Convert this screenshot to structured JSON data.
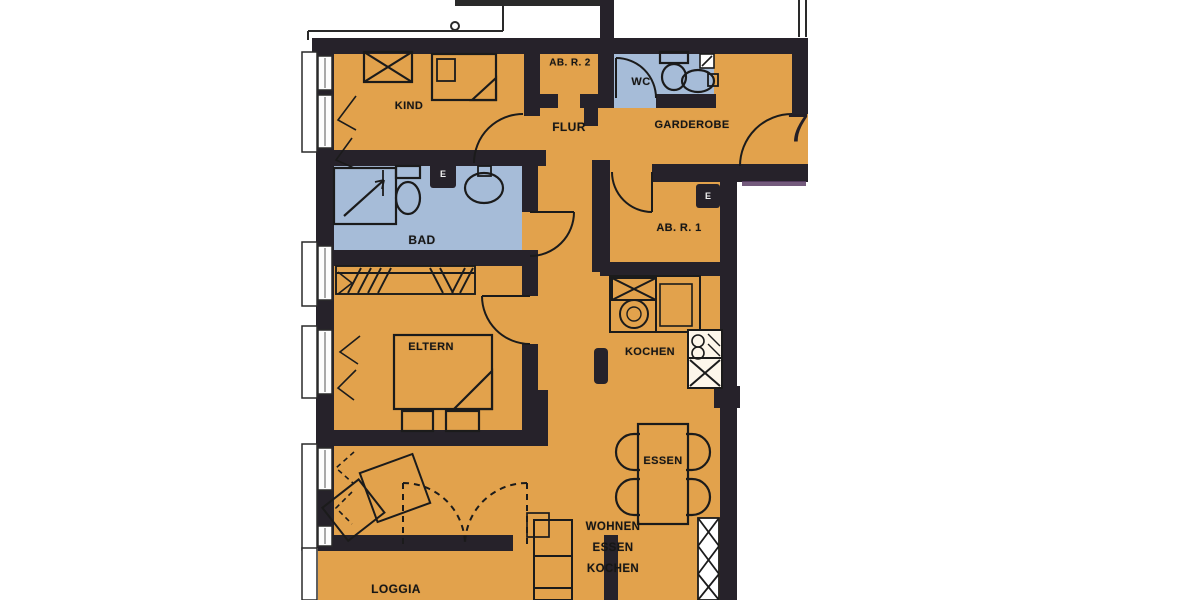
{
  "meta": {
    "apartment_number": "7",
    "drawing_type": "floor plan"
  },
  "colors": {
    "paper": "#ffffff",
    "floor": "#E2A24C",
    "wet": "#A6BCD8",
    "wall": "#26222A",
    "line": "#1b1b1b",
    "artifact": "#5C3E66"
  },
  "rooms": [
    {
      "id": "kind",
      "label": "KIND"
    },
    {
      "id": "ab_r_2",
      "label": "AB. R. 2"
    },
    {
      "id": "wc",
      "label": "WC"
    },
    {
      "id": "flur",
      "label": "FLUR"
    },
    {
      "id": "garderobe",
      "label": "GARDEROBE"
    },
    {
      "id": "bad",
      "label": "BAD"
    },
    {
      "id": "ab_r_1",
      "label": "AB. R. 1"
    },
    {
      "id": "eltern",
      "label": "ELTERN"
    },
    {
      "id": "kochen",
      "label": "KOCHEN"
    },
    {
      "id": "essen",
      "label": "ESSEN"
    },
    {
      "id": "wohnen_essen_kochen",
      "lines": [
        "WOHNEN",
        "ESSEN",
        "KOCHEN"
      ]
    },
    {
      "id": "loggia",
      "label": "LOGGIA"
    }
  ],
  "markers": {
    "electrical_label": "E"
  }
}
